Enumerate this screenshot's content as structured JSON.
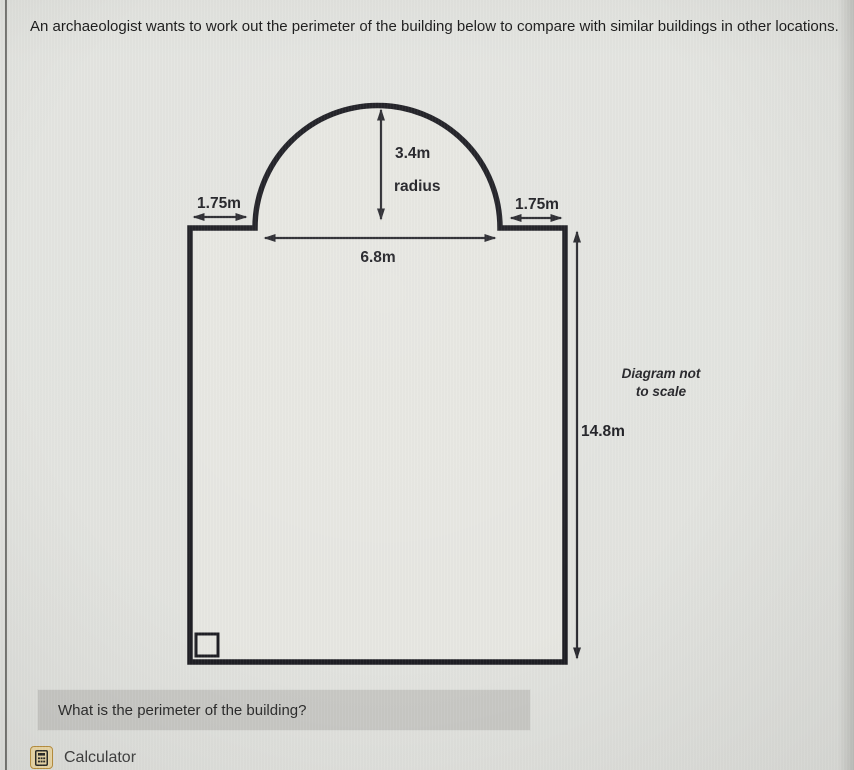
{
  "header": {
    "question_text": "An archaeologist wants to work out the perimeter of the building below to compare with similar buildings in other locations."
  },
  "diagram": {
    "shape": "rectangle-with-semicircular-dome",
    "note_line1": "Diagram not",
    "note_line2": "to scale",
    "dimensions": {
      "radius_value": "3.4m",
      "radius_word": "radius",
      "dome_width": "6.8m",
      "left_offset": "1.75m",
      "right_offset": "1.75m",
      "height": "14.8m"
    },
    "colors": {
      "outline": "#1e1e24",
      "dimension_lines": "#2a2a30",
      "page_background": "#e3e4e0",
      "shape_fill": "#e7e7e2"
    }
  },
  "prompt": {
    "text": "What is the perimeter of the building?",
    "box_color": "#c9c9c5"
  },
  "toolbar": {
    "calculator_label": "Calculator",
    "calculator_icon": "calculator-icon",
    "icon_bg_color": "#ecd9a8"
  }
}
